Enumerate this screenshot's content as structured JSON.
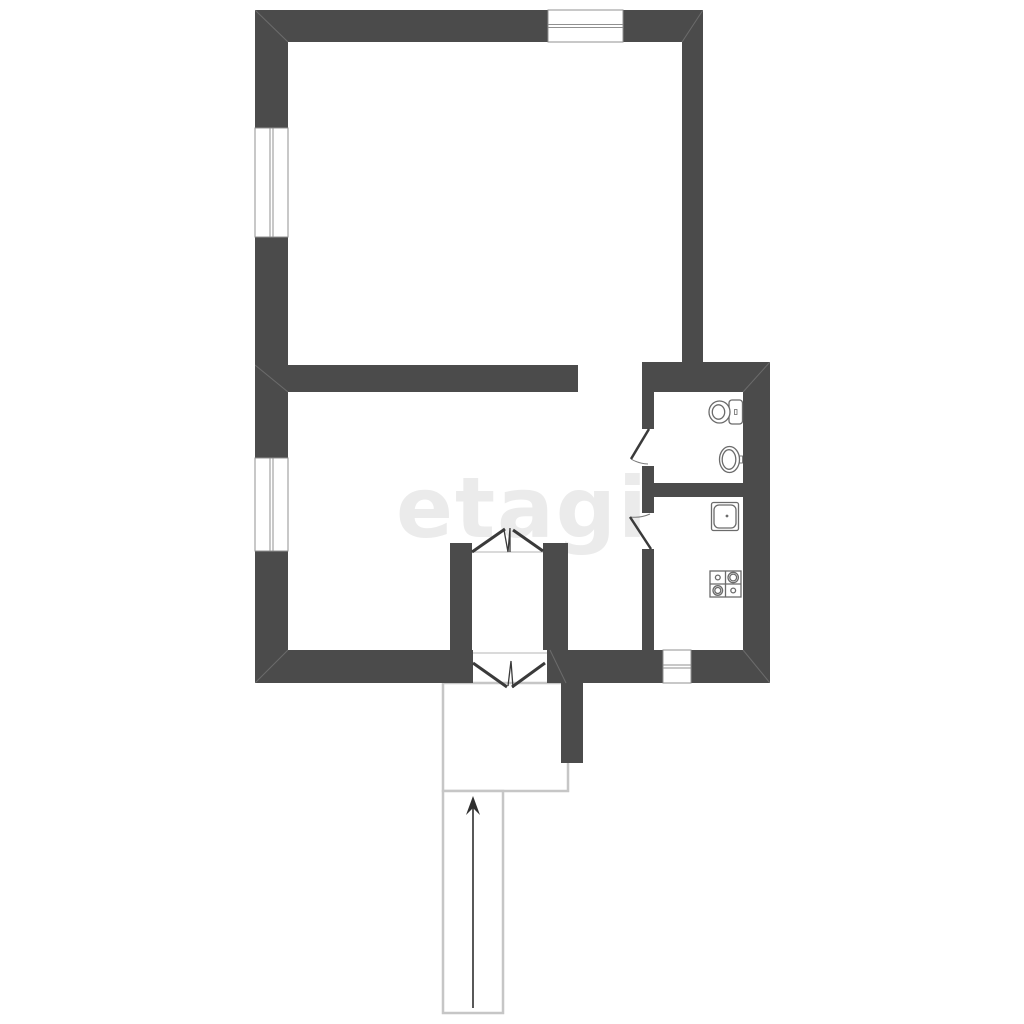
{
  "watermark": {
    "text": "etagi",
    "color": "#ebebeb"
  },
  "plan": {
    "canvas": {
      "width": 1024,
      "height": 1024,
      "background": "#ffffff"
    },
    "colors": {
      "wall": "#4b4b4b",
      "leaf": "#3a3a3a",
      "fixture": "#6b6b6b",
      "window": "#909090",
      "sill": "#b5b5b5",
      "outline": "#c6c6c6",
      "arrow": "#2f2f2f",
      "miter": "rgba(255,255,255,0.18)"
    },
    "walls": [
      {
        "name": "top-wall-left",
        "x": 255,
        "y": 10,
        "w": 293,
        "h": 32
      },
      {
        "name": "top-wall-right",
        "x": 623,
        "y": 10,
        "w": 80,
        "h": 32
      },
      {
        "name": "left-wall-upper",
        "x": 255,
        "y": 10,
        "w": 33,
        "h": 118
      },
      {
        "name": "left-wall-middle",
        "x": 255,
        "y": 237,
        "w": 33,
        "h": 221
      },
      {
        "name": "left-wall-lower",
        "x": 255,
        "y": 551,
        "w": 33,
        "h": 132
      },
      {
        "name": "top-room-right-wall",
        "x": 682,
        "y": 42,
        "w": 21,
        "h": 350
      },
      {
        "name": "middle-wall",
        "x": 255,
        "y": 365,
        "w": 323,
        "h": 27
      },
      {
        "name": "bathroom-top-wall",
        "x": 642,
        "y": 362,
        "w": 128,
        "h": 30
      },
      {
        "name": "right-wall-lower",
        "x": 743,
        "y": 392,
        "w": 27,
        "h": 291
      },
      {
        "name": "bottom-wall-left",
        "x": 255,
        "y": 650,
        "w": 218,
        "h": 33
      },
      {
        "name": "bottom-wall-middle",
        "x": 547,
        "y": 650,
        "w": 116,
        "h": 33
      },
      {
        "name": "bottom-wall-right",
        "x": 691,
        "y": 650,
        "w": 79,
        "h": 33
      },
      {
        "name": "partition-upper",
        "x": 642,
        "y": 392,
        "w": 12,
        "h": 37
      },
      {
        "name": "partition-middle",
        "x": 642,
        "y": 466,
        "w": 12,
        "h": 47
      },
      {
        "name": "partition-lower",
        "x": 642,
        "y": 549,
        "w": 12,
        "h": 101
      },
      {
        "name": "wc-kitchen-divider",
        "x": 642,
        "y": 483,
        "w": 101,
        "h": 14
      },
      {
        "name": "vestibule-left-wall",
        "x": 450,
        "y": 543,
        "w": 22,
        "h": 107
      },
      {
        "name": "vestibule-right-wall",
        "x": 543,
        "y": 543,
        "w": 25,
        "h": 107
      },
      {
        "name": "porch-wall-stub",
        "x": 561,
        "y": 683,
        "w": 22,
        "h": 80
      }
    ],
    "windows": [
      {
        "name": "window-top",
        "dir": "h",
        "x": 548,
        "y": 10,
        "w": 75,
        "h": 32
      },
      {
        "name": "window-left-upper",
        "dir": "v",
        "x": 255,
        "y": 128,
        "w": 33,
        "h": 109
      },
      {
        "name": "window-left-lower",
        "dir": "v",
        "x": 255,
        "y": 458,
        "w": 33,
        "h": 93
      },
      {
        "name": "window-bottom",
        "dir": "h",
        "x": 663,
        "y": 650,
        "w": 28,
        "h": 33
      }
    ],
    "swing_doors": [
      {
        "name": "wc-door",
        "leaf": [
          649,
          429,
          631,
          459
        ],
        "arc": "M631,459 A35,35 0 0 0 648,464"
      },
      {
        "name": "kitchen-door",
        "leaf": [
          651,
          549,
          630,
          517
        ],
        "arc": "M630,517 A38,38 0 0 0 650,514"
      }
    ],
    "double_doors": [
      {
        "name": "vestibule-inner-door",
        "sill": [
          472,
          552,
          543,
          552
        ],
        "leaves": [
          [
            472,
            552,
            505,
            529
          ],
          [
            543,
            551,
            513,
            530
          ]
        ],
        "zigzag": [
          [
            504,
            530
          ],
          [
            508,
            552
          ],
          [
            510,
            528
          ],
          [
            510,
            552
          ]
        ]
      },
      {
        "name": "entrance-door",
        "sill": [
          473,
          653,
          547,
          653
        ],
        "leaves": [
          [
            473,
            663,
            507,
            687
          ],
          [
            545,
            663,
            512,
            687
          ]
        ],
        "zigzag": [
          [
            508,
            686
          ],
          [
            511,
            661
          ],
          [
            513,
            688
          ]
        ]
      }
    ],
    "outlined_areas": [
      {
        "name": "porch",
        "x": 443,
        "y": 683,
        "w": 125,
        "h": 108
      },
      {
        "name": "entry-path",
        "x": 443,
        "y": 791,
        "w": 60,
        "h": 222
      }
    ],
    "entrance_arrow": {
      "name": "entrance-arrow",
      "shaft": [
        473,
        1008,
        473,
        803
      ],
      "head": [
        [
          473,
          796
        ],
        [
          466,
          815
        ],
        [
          473,
          808
        ],
        [
          480,
          815
        ]
      ]
    },
    "fixtures": [
      {
        "name": "toilet-icon",
        "type": "toilet",
        "tank": {
          "x": 729,
          "y": 400,
          "w": 13.5,
          "h": 24,
          "rx": 3
        },
        "tank_mark": {
          "x": 734.5,
          "y": 409.5,
          "w": 2.5,
          "h": 5
        },
        "bowl": {
          "cx": 719.5,
          "cy": 412,
          "rx": 10.5,
          "ry": 11
        },
        "bowl_inner": {
          "cx": 718.5,
          "cy": 412,
          "rx": 6.2,
          "ry": 7.2
        }
      },
      {
        "name": "wash-basin-icon",
        "type": "basin",
        "outer": {
          "cx": 729.5,
          "cy": 459.5,
          "rx": 10,
          "ry": 13
        },
        "inner": {
          "cx": 729,
          "cy": 459.5,
          "rx": 6.8,
          "ry": 9.8
        },
        "tap": {
          "x": 738,
          "y": 456,
          "w": 4.5,
          "h": 7
        }
      },
      {
        "name": "kitchen-sink-icon",
        "type": "sink",
        "outer": {
          "x": 711.5,
          "y": 502.5,
          "w": 27,
          "h": 28,
          "rx": 2
        },
        "inner": {
          "x": 714,
          "y": 505,
          "w": 22,
          "h": 23,
          "rx": 5
        },
        "drain": {
          "cx": 727,
          "cy": 516,
          "r": 1.4
        }
      },
      {
        "name": "stove-icon",
        "type": "stove",
        "frame": {
          "x": 710,
          "y": 571,
          "w": 31,
          "h": 26
        },
        "burners": [
          {
            "cx": 717.8,
            "cy": 577.5,
            "r": 2.4
          },
          {
            "cx": 733.2,
            "cy": 577.5,
            "r": 5.2,
            "r2": 3.4
          },
          {
            "cx": 717.8,
            "cy": 590.5,
            "r": 4.8,
            "r2": 3
          },
          {
            "cx": 733.2,
            "cy": 590.5,
            "r": 2.4
          }
        ]
      }
    ],
    "miters": [
      [
        255,
        10,
        288,
        42
      ],
      [
        703,
        10,
        682,
        42
      ],
      [
        255,
        683,
        288,
        650
      ],
      [
        770,
        683,
        743,
        650
      ],
      [
        770,
        362,
        743,
        392
      ],
      [
        550,
        650,
        566,
        683
      ],
      [
        255,
        365,
        288,
        392
      ]
    ]
  }
}
